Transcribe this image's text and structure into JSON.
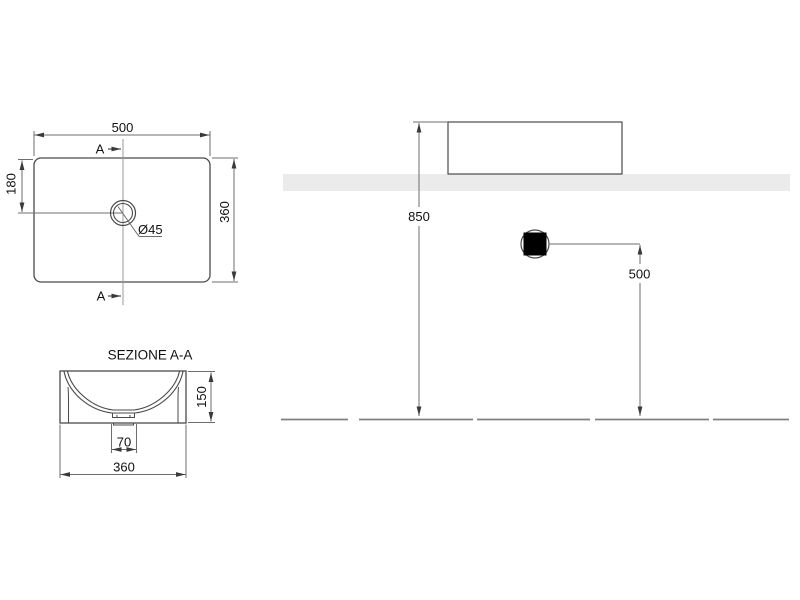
{
  "plan": {
    "width": "500",
    "depth": "360",
    "drain_offset": "180",
    "drain_diameter": "Ø45",
    "section_label_top": "A",
    "section_label_bottom": "A"
  },
  "section": {
    "title": "SEZIONE A-A",
    "height": "150",
    "drain_width": "70",
    "width": "360"
  },
  "installation": {
    "rim_height": "850",
    "drain_height": "500"
  },
  "colors": {
    "outline": "#4a4a4a",
    "dim_line": "#6e6e6e",
    "arrow": "#3a3a3a",
    "section_line": "#999999",
    "counter_fill": "#ebebeb",
    "drain_square_fill": "#000000",
    "floor_line": "#808080",
    "background": "#ffffff"
  }
}
